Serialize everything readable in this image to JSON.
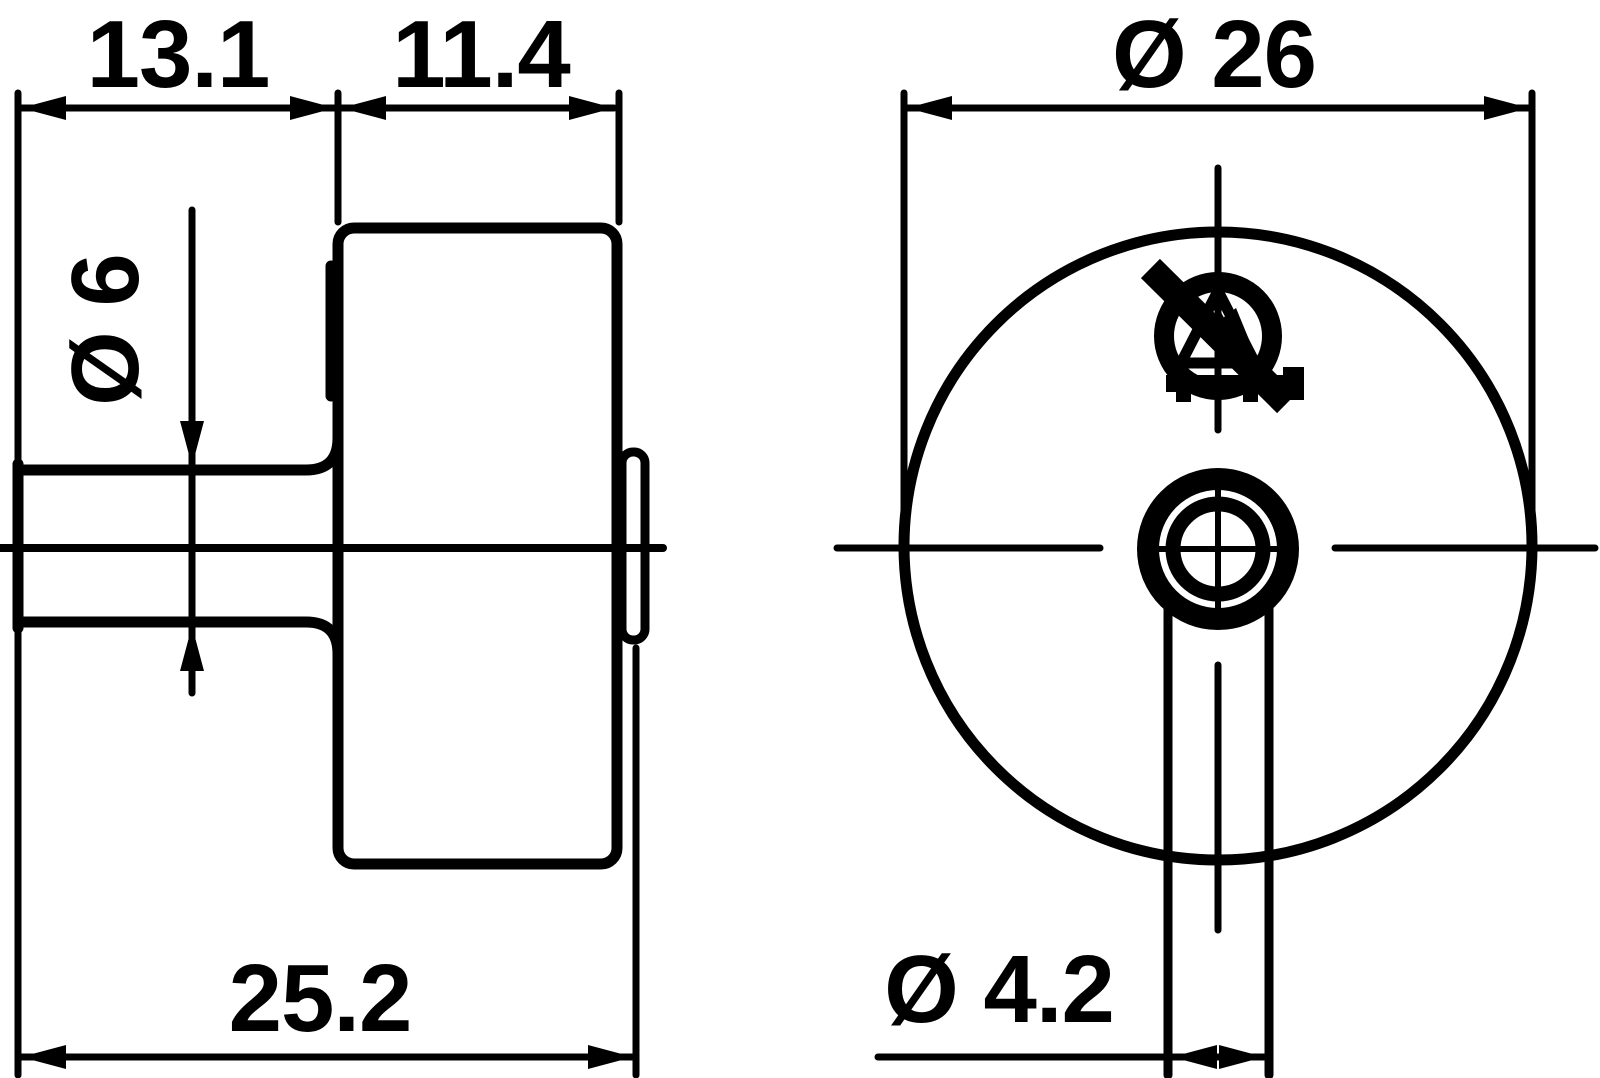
{
  "colors": {
    "ink": "#000000",
    "background": "#ffffff"
  },
  "views": {
    "side": {
      "label_shaft_length": "13.1",
      "label_body_depth": "11.4",
      "label_shaft_diameter": "Ø 6",
      "label_overall_length": "25.2"
    },
    "front": {
      "label_outer_diameter": "Ø 26",
      "label_hole_diameter": "Ø 4.2",
      "symbol": "esd-warning-symbol"
    }
  }
}
